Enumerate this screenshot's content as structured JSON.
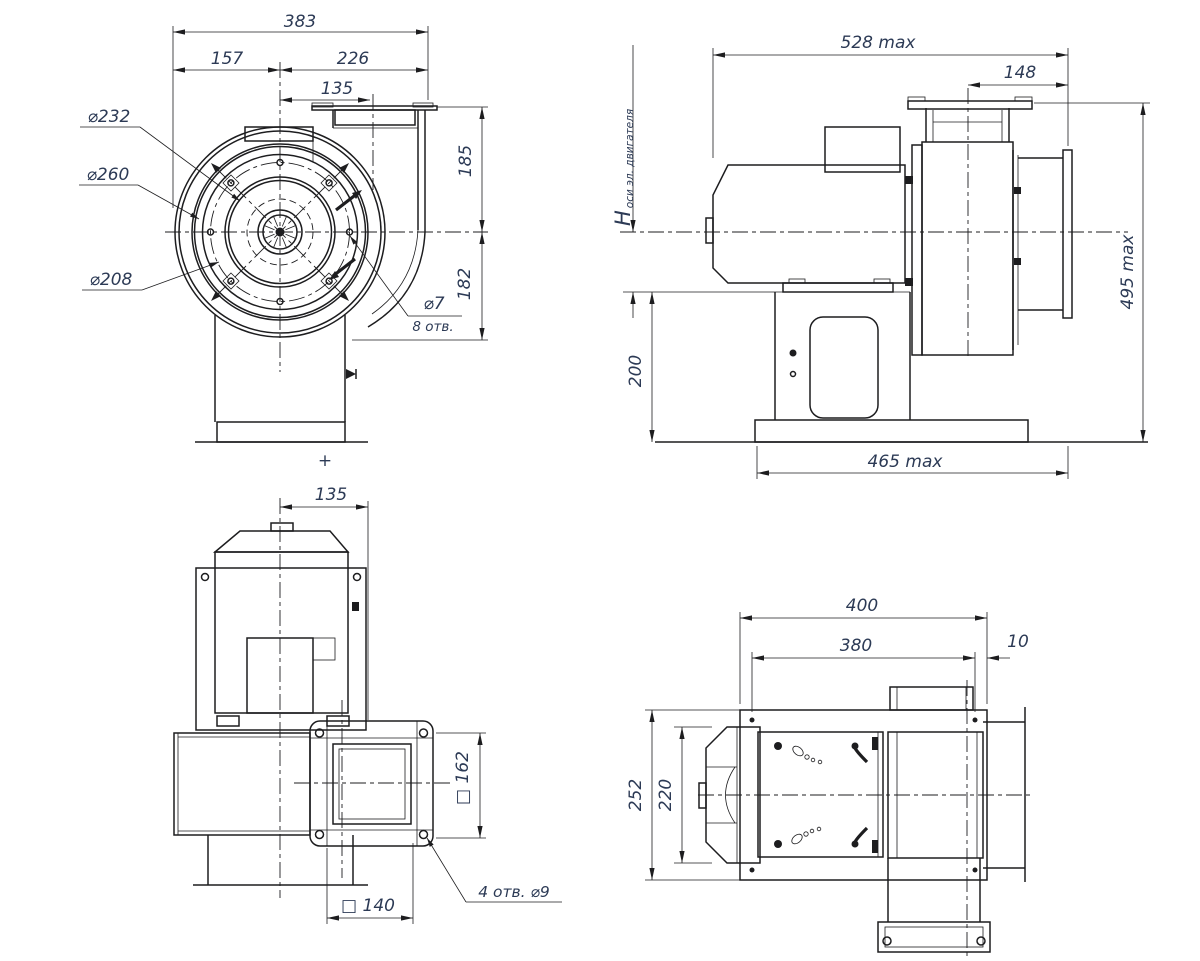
{
  "page": {
    "background": "#ffffff",
    "line_color": "#1d1d1f",
    "text_color": "#2c3a55"
  },
  "front_view": {
    "width_total": "383",
    "width_to_axis": "157",
    "width_axis_to_right": "226",
    "outlet_offset": "135",
    "height_axis_to_top": "185",
    "height_axis_to_bottom": "182",
    "dia_back_plate": "⌀232",
    "dia_inlet_collar": "⌀260",
    "dia_bolt_circle": "⌀208",
    "holes_dia": "⌀7",
    "holes_count": "8 отв.",
    "plus_mark": "+"
  },
  "side_view": {
    "length_max": "528 max",
    "inlet_depth": "148",
    "motor_axis_symbol": "H",
    "motor_axis_note": "оси эл. двигателя",
    "pedestal_height": "200",
    "height_max": "495 max",
    "base_length_max": "465 max"
  },
  "rear_view": {
    "axis_to_outlet": "135",
    "outlet_square": "□ 162",
    "outlet_bolt_square": "□ 140",
    "outlet_holes_note": "4 отв.  ⌀9"
  },
  "top_view": {
    "base_length": "400",
    "bolt_spacing_length": "380",
    "edge_offset": "10",
    "base_width": "252",
    "bolt_spacing_width": "220"
  }
}
